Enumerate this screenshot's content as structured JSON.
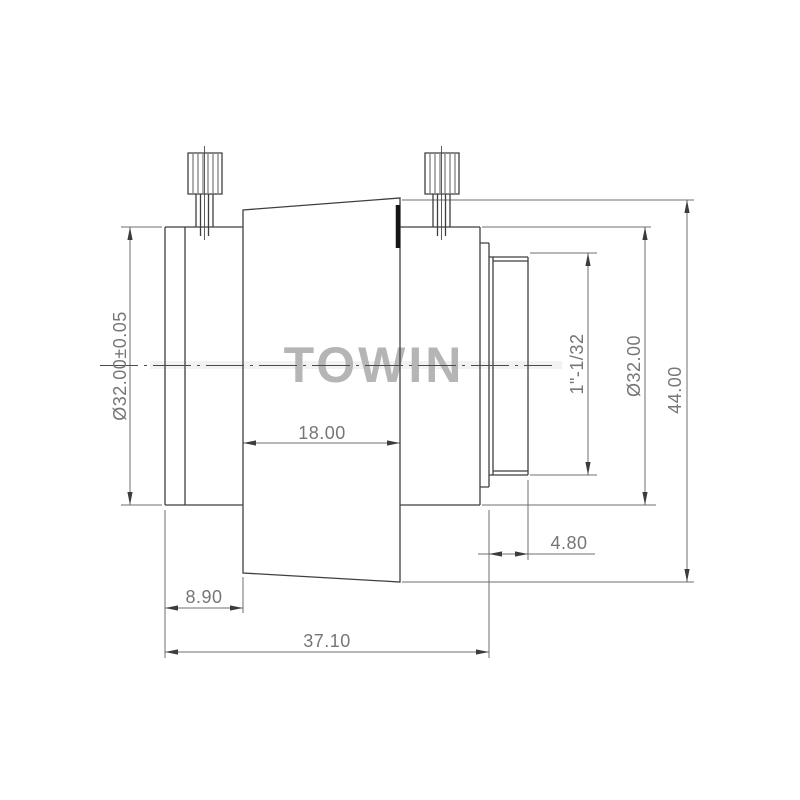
{
  "drawing": {
    "kind": "lens-technical-drawing",
    "view": "side-elevation",
    "colors": {
      "background": "#ffffff",
      "outline": "#3f3f3f",
      "dimension_lines": "#6f6f6f",
      "dimension_text": "#767676",
      "watermark": "#b5b5b5",
      "index_mark": "#151515"
    }
  },
  "watermark": {
    "text": "TOWIN"
  },
  "dimensions": {
    "front_diameter": "Ø32.00±0.05",
    "front_length": "8.90",
    "cone_length": "18.00",
    "total_length": "37.10",
    "thread_length": "4.80",
    "thread_spec": "1\"-1/32",
    "rear_diameter": "Ø32.00",
    "max_diameter": "44.00"
  }
}
